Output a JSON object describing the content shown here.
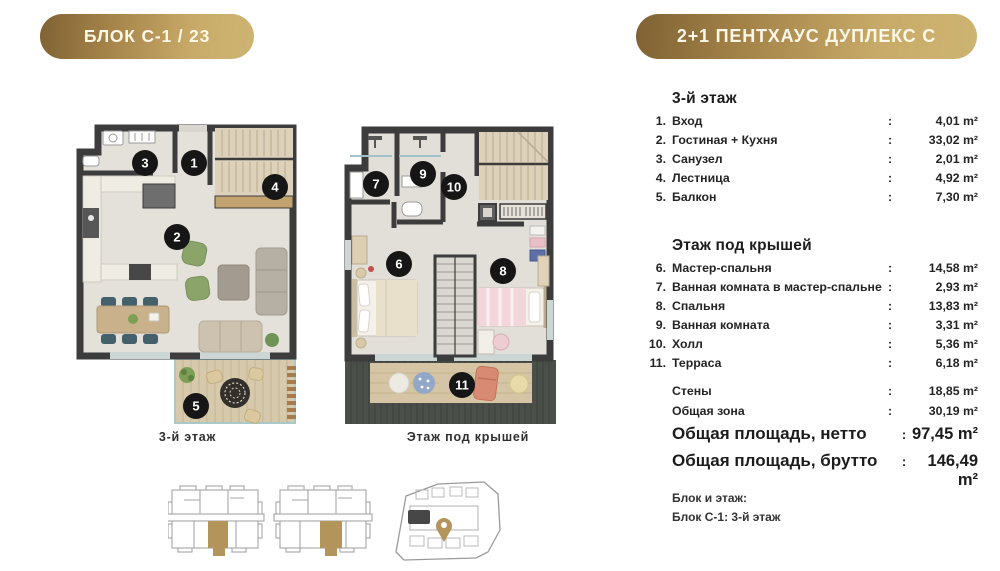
{
  "badges": {
    "block": "БЛОК С-1 / 23",
    "unit_type": "2+1 ПЕНТХАУС ДУПЛЕКС С"
  },
  "plans": {
    "floor3": {
      "label": "3-й этаж",
      "markers": [
        "1",
        "2",
        "3",
        "4",
        "5"
      ]
    },
    "attic": {
      "label": "Этаж под крышей",
      "markers": [
        "6",
        "7",
        "8",
        "9",
        "10",
        "11"
      ]
    }
  },
  "areas": {
    "colon": ":",
    "sections": [
      {
        "title": "3-й этаж",
        "rows": [
          {
            "num": "1.",
            "name": "Вход",
            "value": "4,01 m²"
          },
          {
            "num": "2.",
            "name": "Гостиная + Кухня",
            "value": "33,02 m²"
          },
          {
            "num": "3.",
            "name": "Санузел",
            "value": "2,01 m²"
          },
          {
            "num": "4.",
            "name": "Лестница",
            "value": "4,92 m²"
          },
          {
            "num": "5.",
            "name": "Балкон",
            "value": "7,30 m²"
          }
        ]
      },
      {
        "title": "Этаж под крышей",
        "rows": [
          {
            "num": "6.",
            "name": "Мастер-спальня",
            "value": "14,58 m²"
          },
          {
            "num": "7.",
            "name": "Ванная комната в мастер-спальне",
            "value": "2,93 m²"
          },
          {
            "num": "8.",
            "name": "Спальня",
            "value": "13,83 m²"
          },
          {
            "num": "9.",
            "name": "Ванная комната",
            "value": "3,31 m²"
          },
          {
            "num": "10.",
            "name": "Холл",
            "value": "5,36 m²"
          },
          {
            "num": "11.",
            "name": "Терраса",
            "value": "6,18 m²"
          }
        ]
      }
    ],
    "extras": [
      {
        "name": "Стены",
        "value": "18,85 m²"
      },
      {
        "name": "Общая зона",
        "value": "30,19 m²"
      }
    ],
    "totals": [
      {
        "name": "Общая площадь, нетто",
        "value": "97,45 m²"
      },
      {
        "name": "Общая площадь, брутто",
        "value": "146,49 m²"
      }
    ]
  },
  "footer": {
    "label": "Блок и этаж:",
    "value": "Блок С-1: 3-й этаж"
  },
  "colors": {
    "gold": "#b3955c",
    "gold_gradient_start": "#7f6234",
    "gold_gradient_end": "#cdb472",
    "wall": "#3c3c3c",
    "floor": "#e4e1db",
    "marker": "#161616"
  }
}
